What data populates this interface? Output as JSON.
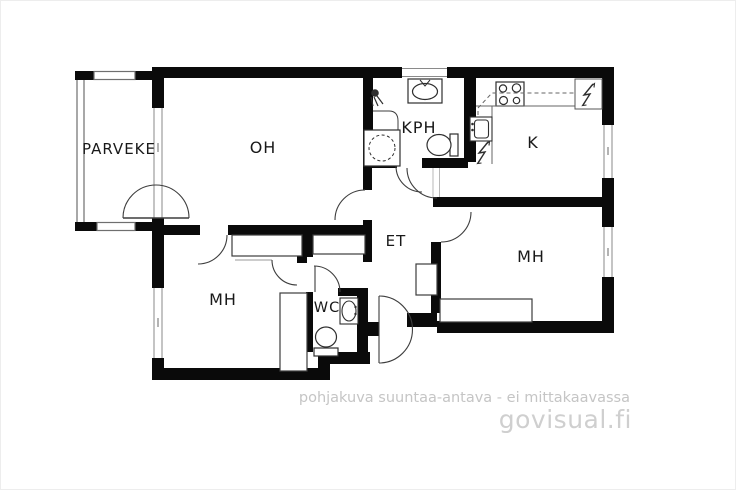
{
  "plan": {
    "type": "apartment-floor-plan",
    "rooms": {
      "parveke": {
        "label": "PARVEKE"
      },
      "oh": {
        "label": "OH"
      },
      "kph": {
        "label": "KPH"
      },
      "k": {
        "label": "K"
      },
      "et": {
        "label": "ET"
      },
      "mh_right": {
        "label": "MH"
      },
      "mh_left": {
        "label": "MH"
      },
      "wc": {
        "label": "WC"
      }
    },
    "fixtures": [
      "shower-icon",
      "bathroom-sink-icon",
      "washing-machine-icon",
      "toilet-icon",
      "stove-icon",
      "kitchen-sink-icon",
      "electric-symbol-icon",
      "fridge-nook",
      "wc-sink-icon",
      "wc-toilet-icon",
      "wardrobe",
      "door-arc",
      "window"
    ],
    "colors": {
      "background": "#ffffff",
      "wall": "#0a0a0a",
      "thin_line": "#3d3d3d",
      "window_line": "#8a8a8a",
      "label": "#191919",
      "muted_text": "#c5c5c5",
      "brand_text": "#cfcfcf"
    }
  },
  "footer": {
    "disclaimer": "pohjakuva suuntaa-antava - ei mittakaavassa",
    "brand": "govisual.fi"
  }
}
